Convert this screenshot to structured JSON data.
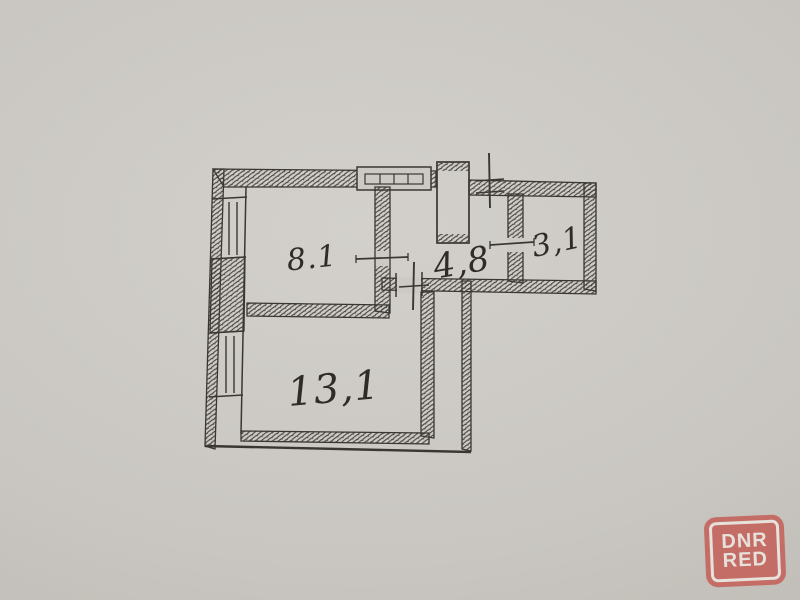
{
  "floor_plan": {
    "rooms": [
      {
        "id": "room-top-left",
        "area_label": "8.1"
      },
      {
        "id": "room-corridor",
        "area_label": "4,8"
      },
      {
        "id": "room-top-right",
        "area_label": "3,1"
      },
      {
        "id": "room-bottom",
        "area_label": "13,1"
      }
    ]
  },
  "watermark": {
    "line1": "DNR",
    "line2": "RED"
  },
  "colors": {
    "paper": "#cbc8c3",
    "ink": "#3a3733",
    "watermark_red": "#c4625b",
    "watermark_text": "#ece6e0"
  }
}
